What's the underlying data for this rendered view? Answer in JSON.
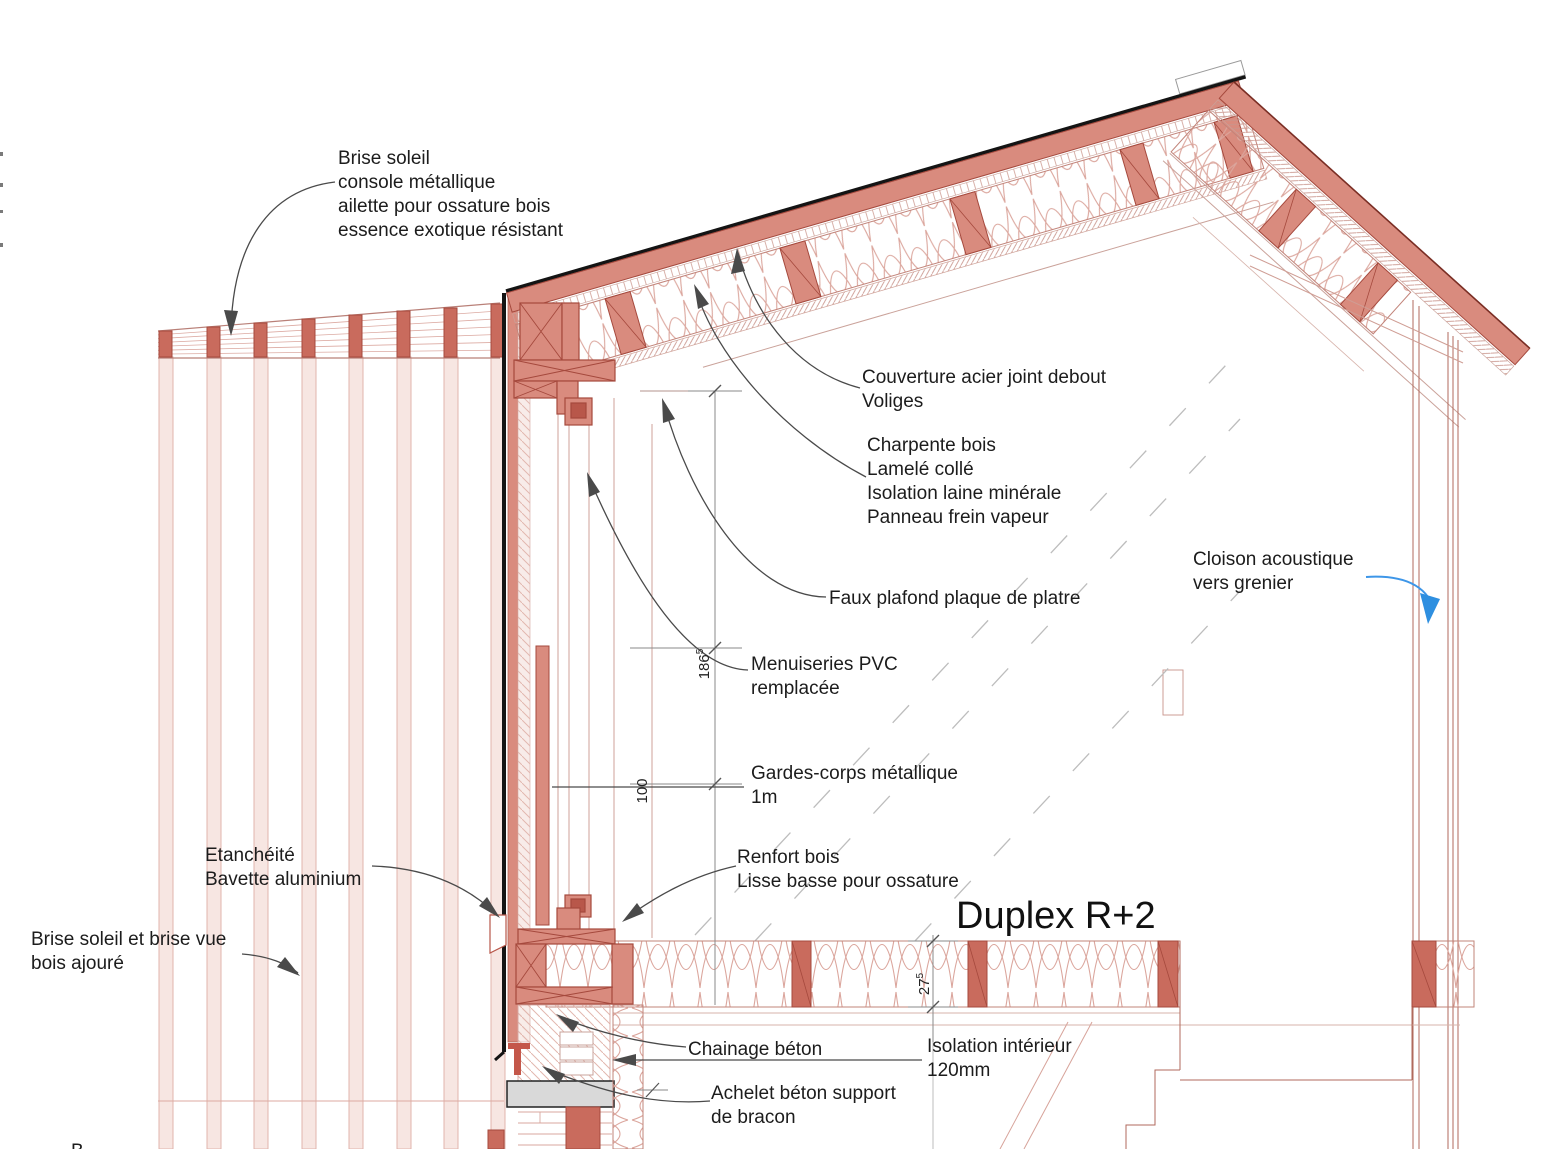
{
  "drawing": {
    "type": "architectural-section-detail",
    "title": "Duplex R+2",
    "labels": {
      "brise_soleil": "Brise soleil\nconsole métallique\nailette pour ossature bois\nessence exotique résistant",
      "couverture": "Couverture acier joint debout\nVoliges",
      "charpente": "Charpente bois\nLamelé collé\nIsolation laine minérale\nPanneau frein vapeur",
      "cloison": "Cloison acoustique\nvers grenier",
      "faux_plafond": "Faux plafond plaque de platre",
      "menuiseries": "Menuiseries PVC\nremplacée",
      "gardes_corps": "Gardes-corps métallique\n1m",
      "etancheite": "Etanchéité\nBavette aluminium",
      "renfort": "Renfort bois\nLisse basse pour ossature",
      "brise_vue": "Brise soleil et brise vue\nbois ajouré",
      "chainage": "Chainage béton",
      "isolation_interieur": "Isolation intérieur\n120mm",
      "achelet": "Achelet béton support\nde bracon"
    },
    "dimensions": {
      "d186": {
        "value": "186",
        "sup": "5"
      },
      "d100": {
        "value": "100",
        "sup": ""
      },
      "d27": {
        "value": "27",
        "sup": "5"
      }
    },
    "partial_text": "B",
    "colors": {
      "salmon_fill": "#d98b7e",
      "dark_red_line": "#a5493d",
      "stud_red": "#c96b5d",
      "pale_pink": "#f7e6e2",
      "pink_line": "#cf9d94",
      "section_black": "#141414",
      "leader_gray": "#4a4a4a",
      "hidden_dash_gray": "#bdbdbd",
      "annotation_blue": "#3d96e8",
      "concrete_gray": "#d9d9d9"
    }
  }
}
